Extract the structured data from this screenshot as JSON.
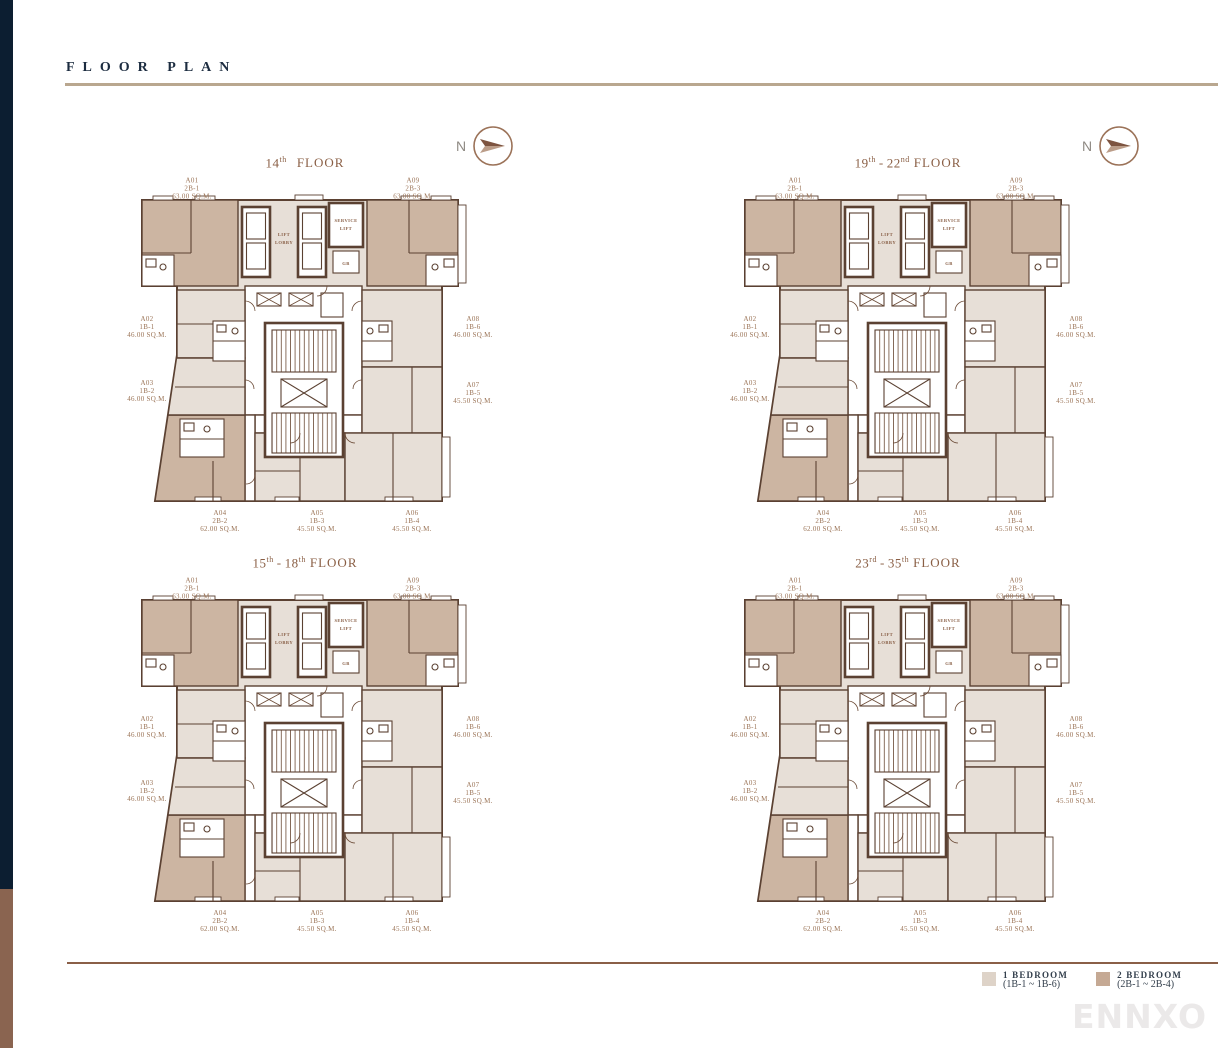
{
  "header": {
    "title": "FLOOR PLAN"
  },
  "compass": {
    "label": "N"
  },
  "plans": [
    {
      "title": {
        "start": "14",
        "start_sup": "th",
        "sep": "",
        "end": "",
        "end_sup": "",
        "word": "FLOOR"
      }
    },
    {
      "title": {
        "start": "19",
        "start_sup": "th",
        "sep": "-",
        "end": "22",
        "end_sup": "nd",
        "word": "FLOOR"
      }
    },
    {
      "title": {
        "start": "15",
        "start_sup": "th",
        "sep": "-",
        "end": "18",
        "end_sup": "th",
        "word": "FLOOR"
      }
    },
    {
      "title": {
        "start": "23",
        "start_sup": "rd",
        "sep": "-",
        "end": "35",
        "end_sup": "th",
        "word": "FLOOR"
      }
    }
  ],
  "units": [
    {
      "id": "A01",
      "type": "2B-1",
      "area": "63.00 SQ.M.",
      "bedrooms": "2 BEDROOM"
    },
    {
      "id": "A02",
      "type": "1B-1",
      "area": "46.00 SQ.M.",
      "bedrooms": "1 BEDROOM"
    },
    {
      "id": "A03",
      "type": "1B-2",
      "area": "46.00 SQ.M.",
      "bedrooms": "1 BEDROOM"
    },
    {
      "id": "A04",
      "type": "2B-2",
      "area": "62.00 SQ.M.",
      "bedrooms": "2 BEDROOM"
    },
    {
      "id": "A05",
      "type": "1B-3",
      "area": "45.50 SQ.M.",
      "bedrooms": "1 BEDROOM"
    },
    {
      "id": "A06",
      "type": "1B-4",
      "area": "45.50 SQ.M.",
      "bedrooms": "1 BEDROOM"
    },
    {
      "id": "A07",
      "type": "1B-5",
      "area": "45.50 SQ.M.",
      "bedrooms": "1 BEDROOM"
    },
    {
      "id": "A08",
      "type": "1B-6",
      "area": "46.00 SQ.M.",
      "bedrooms": "1 BEDROOM"
    },
    {
      "id": "A09",
      "type": "2B-3",
      "area": "63.00 SQ.M.",
      "bedrooms": "2 BEDROOM"
    }
  ],
  "core_labels": {
    "lift_lobby_1": "LIFT",
    "lift_lobby_2": "LOBBY",
    "service_lift_1": "SERVICE",
    "service_lift_2": "LIFT",
    "gb": "GB"
  },
  "legend": [
    {
      "label": "1 BEDROOM",
      "range": "(1B-1 ~ 1B-6)",
      "color": "#ded3c8"
    },
    {
      "label": "2 BEDROOM",
      "range": "(2B-1 ~ 2B-4)",
      "color": "#c5a994"
    }
  ],
  "watermark": "ENNXO",
  "colors": {
    "header_navy": "#1c2c40",
    "header_rule_tan": "#b9a78f",
    "footer_rule_brown": "#8a5f47",
    "sidebar_navy": "#0c1e31",
    "sidebar_brown": "#8a6450",
    "wall_brown": "#5b4132",
    "unit_1_bedroom_fill": "#e7dfd7",
    "unit_2_bedroom_fill": "#ccb5a2",
    "label_brown": "#9b7457"
  }
}
